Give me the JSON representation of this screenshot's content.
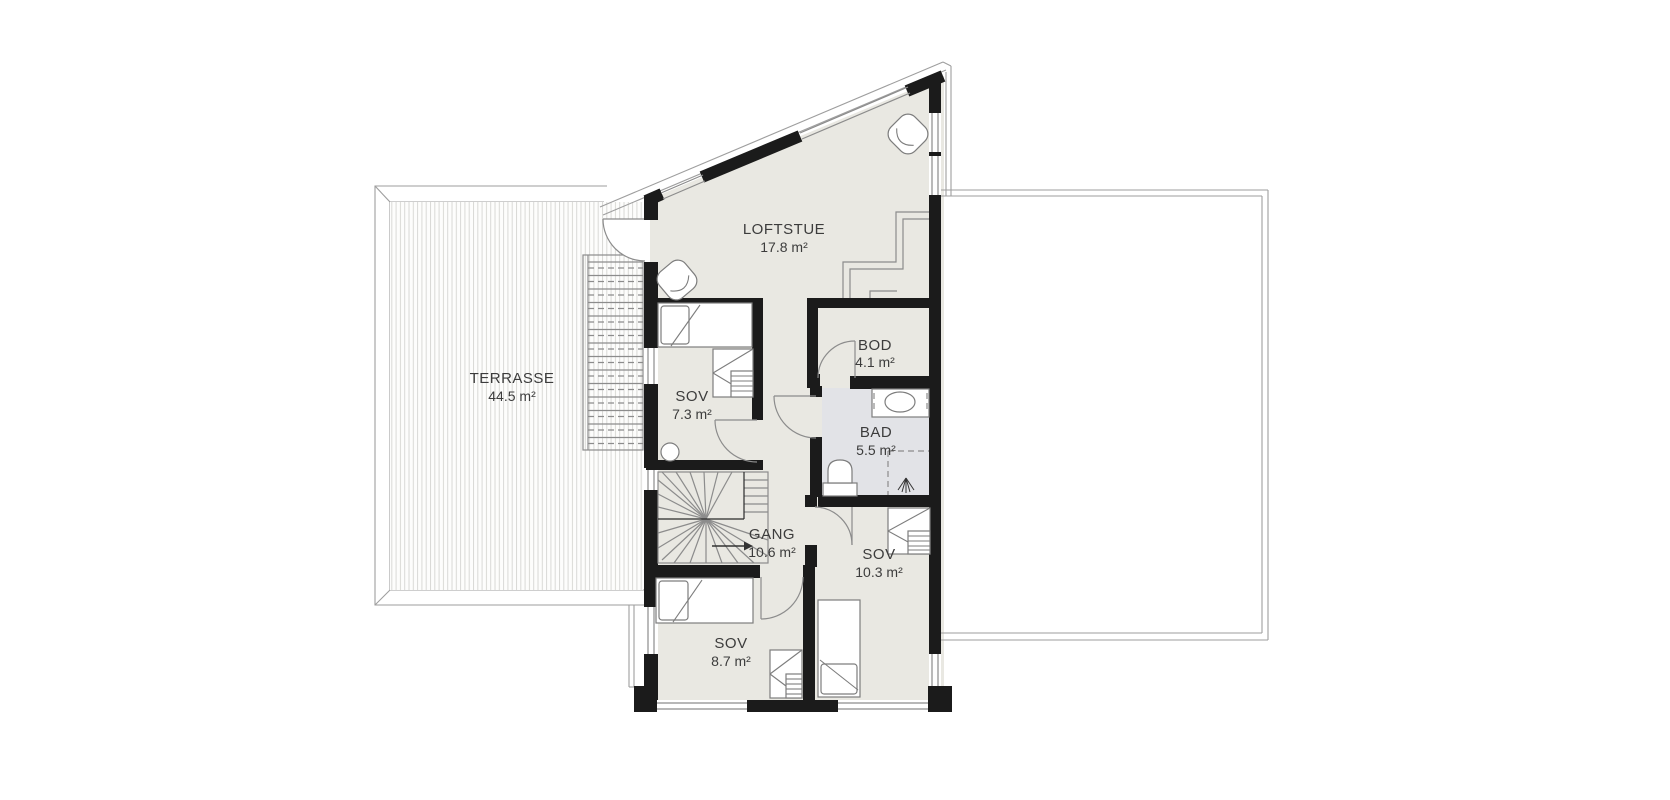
{
  "plan": {
    "title": "Loft floor plan",
    "rooms": [
      {
        "id": "terrasse",
        "name": "TERRASSE",
        "area": "44.5 m²"
      },
      {
        "id": "loftstue",
        "name": "LOFTSTUE",
        "area": "17.8 m²"
      },
      {
        "id": "sov1",
        "name": "SOV",
        "area": "7.3 m²"
      },
      {
        "id": "bod",
        "name": "BOD",
        "area": "4.1 m²"
      },
      {
        "id": "bad",
        "name": "BAD",
        "area": "5.5 m²"
      },
      {
        "id": "gang",
        "name": "GANG",
        "area": "10.6 m²"
      },
      {
        "id": "sov2",
        "name": "SOV",
        "area": "10.3 m²"
      },
      {
        "id": "sov3",
        "name": "SOV",
        "area": "8.7 m²"
      }
    ],
    "colors": {
      "wall": "#1b1b1b",
      "floor": "#e9e8e2",
      "bath_floor": "#e2e3e7",
      "line": "#8c8c8c",
      "outline": "#9e9e9e",
      "furn": "#7d7d7d",
      "deck_line": "#d9d9d6",
      "text": "#3c3c3c"
    }
  }
}
